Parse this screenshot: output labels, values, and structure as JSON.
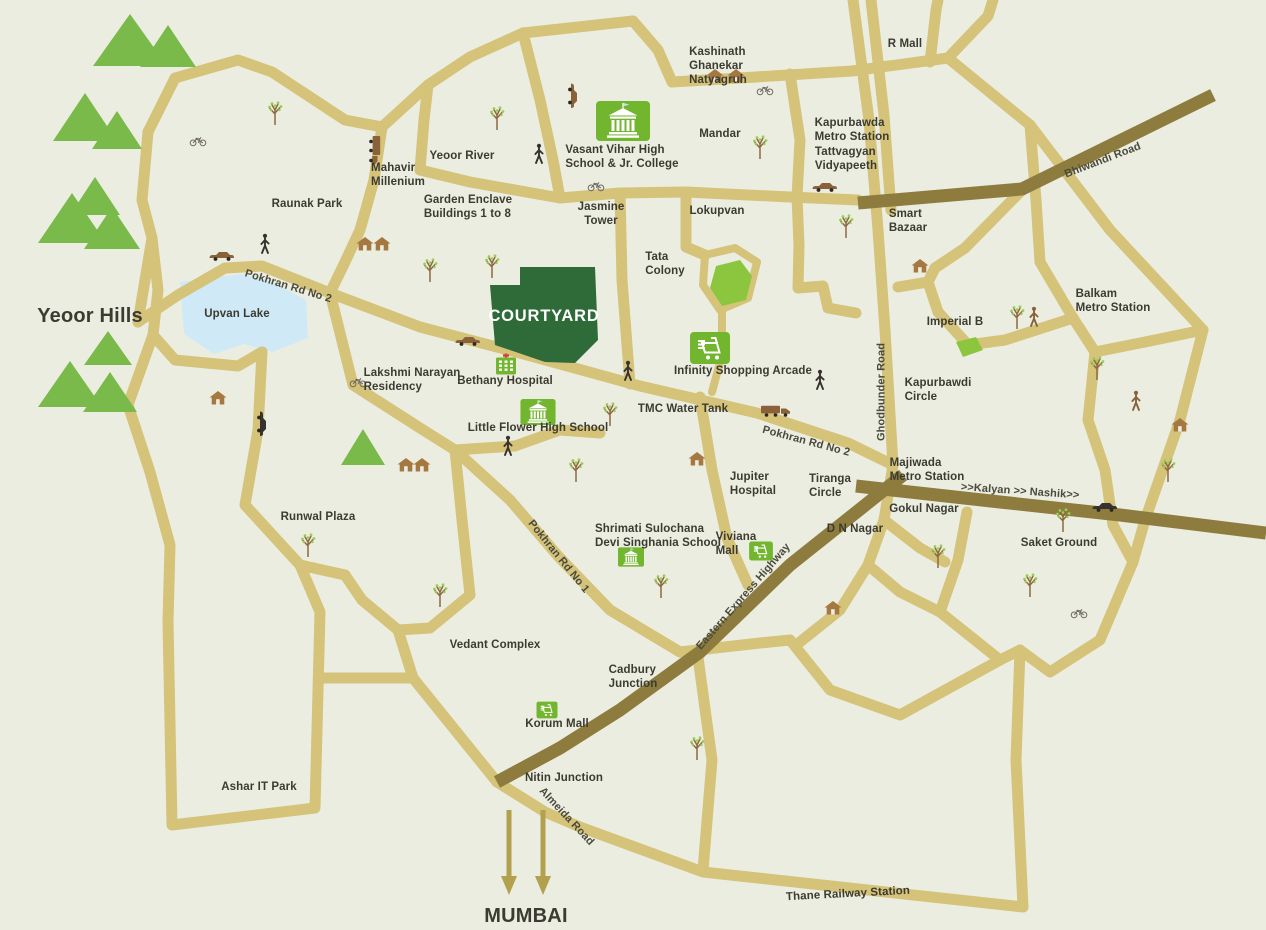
{
  "map_name": "courtyard-thane-location-map",
  "colors": {
    "background": "#ecede1",
    "road_tan": "#d5c37a",
    "highway_olive": "#8d7c3e",
    "text_ink": "#3b3b31",
    "road_label": "#4a4a3c",
    "courtyard_green": "#2e6b38",
    "hills_green": "#79ba4b",
    "colony_green": "#8cc63f",
    "landmark_icon_green": "#72b52e",
    "lake_blue": "#cfe9f6",
    "house_brown": "#a5783f",
    "cross_red": "#d84338",
    "arrow_gold": "#b2a04e"
  },
  "labels": [
    {
      "id": "yeoor-hills",
      "text": "Yeoor Hills",
      "x": 90,
      "y": 316,
      "cls": "big"
    },
    {
      "id": "mumbai",
      "text": "MUMBAI",
      "x": 526,
      "y": 916,
      "cls": "big ctr"
    },
    {
      "id": "courtyard",
      "text": "COURTYARD",
      "x": 544,
      "y": 316,
      "cls": "white ctr"
    },
    {
      "id": "kashinath-ghanekar-natyagruh",
      "text": "Kashinath\nGhanekar\nNatyagruh",
      "x": 718,
      "y": 66
    },
    {
      "id": "r-mall",
      "text": "R Mall",
      "x": 905,
      "y": 44
    },
    {
      "id": "mandar",
      "text": "Mandar",
      "x": 720,
      "y": 134
    },
    {
      "id": "kapurbawda-metro-station",
      "text": "Kapurbawda\nMetro Station",
      "x": 852,
      "y": 130
    },
    {
      "id": "tattvagyan-vidyapeeth",
      "text": "Tattvagyan\nVidyapeeth",
      "x": 846,
      "y": 159
    },
    {
      "id": "bhiwandi-road",
      "text": "Bhiwandi Road",
      "x": 1103,
      "y": 161,
      "rot": -21,
      "cls": "road-lbl"
    },
    {
      "id": "vasant-vihar-school",
      "text": "Vasant Vihar High\nSchool & Jr. College",
      "x": 622,
      "y": 157
    },
    {
      "id": "yeoor-river",
      "text": "Yeoor River",
      "x": 462,
      "y": 156
    },
    {
      "id": "mahavir-millenium",
      "text": "Mahavir\nMillenium",
      "x": 398,
      "y": 175
    },
    {
      "id": "garden-enclave",
      "text": "Garden Enclave\nBuildings 1 to 8",
      "x": 468,
      "y": 207
    },
    {
      "id": "jasmine-tower",
      "text": "Jasmine\nTower",
      "x": 601,
      "y": 214,
      "cls": "ctr"
    },
    {
      "id": "lokupvan",
      "text": "Lokupvan",
      "x": 717,
      "y": 211
    },
    {
      "id": "raunak-park",
      "text": "Raunak Park",
      "x": 307,
      "y": 204
    },
    {
      "id": "smart-bazaar",
      "text": "Smart\nBazaar",
      "x": 908,
      "y": 221
    },
    {
      "id": "tata-colony",
      "text": "Tata\nColony",
      "x": 665,
      "y": 264
    },
    {
      "id": "balkam-metro-station",
      "text": "Balkam\nMetro Station",
      "x": 1113,
      "y": 301
    },
    {
      "id": "pokhran-rd-2-west",
      "text": "Pokhran Rd No 2",
      "x": 288,
      "y": 287,
      "rot": 17,
      "cls": "road-lbl"
    },
    {
      "id": "upvan-lake",
      "text": "Upvan Lake",
      "x": 237,
      "y": 314
    },
    {
      "id": "imperial-b",
      "text": "Imperial B",
      "x": 955,
      "y": 322
    },
    {
      "id": "bethany-hospital",
      "text": "Bethany Hospital",
      "x": 505,
      "y": 381
    },
    {
      "id": "lakshmi-narayan-residency",
      "text": "Lakshmi Narayan\nResidency",
      "x": 412,
      "y": 380
    },
    {
      "id": "infinity-shopping-arcade",
      "text": "Infinity Shopping Arcade",
      "x": 743,
      "y": 371
    },
    {
      "id": "ghodbunder-road",
      "text": "Ghodbunder Road",
      "x": 882,
      "y": 392,
      "rot": -90,
      "cls": "road-lbl"
    },
    {
      "id": "kapurbawdi-circle",
      "text": "Kapurbawdi\nCircle",
      "x": 938,
      "y": 390
    },
    {
      "id": "little-flower-high-school",
      "text": "Little Flower High School",
      "x": 538,
      "y": 428
    },
    {
      "id": "tmc-water-tank",
      "text": "TMC Water Tank",
      "x": 683,
      "y": 409
    },
    {
      "id": "pokhran-rd-2-east",
      "text": "Pokhran Rd No 2",
      "x": 806,
      "y": 442,
      "rot": 15,
      "cls": "road-lbl"
    },
    {
      "id": "majiwada-metro-station",
      "text": "Majiwada\nMetro Station",
      "x": 927,
      "y": 470
    },
    {
      "id": "jupiter-hospital",
      "text": "Jupiter\nHospital",
      "x": 753,
      "y": 484
    },
    {
      "id": "tiranga-circle",
      "text": "Tiranga\nCircle",
      "x": 830,
      "y": 486
    },
    {
      "id": "d-n-nagar",
      "text": "D N Nagar",
      "x": 855,
      "y": 529
    },
    {
      "id": "kalyan-nashik",
      "text": ">>Kalyan >> Nashik>>",
      "x": 1020,
      "y": 492,
      "rot": 4,
      "cls": "road-lbl"
    },
    {
      "id": "gokul-nagar",
      "text": "Gokul Nagar",
      "x": 924,
      "y": 509
    },
    {
      "id": "saket-ground",
      "text": "Saket Ground",
      "x": 1059,
      "y": 543
    },
    {
      "id": "runwal-plaza",
      "text": "Runwal Plaza",
      "x": 318,
      "y": 517
    },
    {
      "id": "shrimati-sulochana-school",
      "text": "Shrimati Sulochana\nDevi Singhania School",
      "x": 658,
      "y": 536
    },
    {
      "id": "viviana-mall",
      "text": "Viviana\nMall",
      "x": 736,
      "y": 544
    },
    {
      "id": "eastern-express-highway",
      "text": "Eastern Express Highway",
      "x": 744,
      "y": 597,
      "rot": -49,
      "cls": "road-lbl"
    },
    {
      "id": "pokhran-rd-1",
      "text": "Pokhran Rd No 1",
      "x": 558,
      "y": 557,
      "rot": 51,
      "cls": "road-lbl"
    },
    {
      "id": "vedant-complex",
      "text": "Vedant Complex",
      "x": 495,
      "y": 645
    },
    {
      "id": "cadbury-junction",
      "text": "Cadbury\nJunction",
      "x": 633,
      "y": 677
    },
    {
      "id": "korum-mall",
      "text": "Korum Mall",
      "x": 557,
      "y": 724
    },
    {
      "id": "nitin-junction",
      "text": "Nitin Junction",
      "x": 564,
      "y": 778
    },
    {
      "id": "almeida-road",
      "text": "Almeida Road",
      "x": 566,
      "y": 817,
      "rot": 47,
      "cls": "road-lbl"
    },
    {
      "id": "ashar-it-park",
      "text": "Ashar IT Park",
      "x": 259,
      "y": 787
    },
    {
      "id": "thane-railway-station",
      "text": "Thane Railway Station",
      "x": 848,
      "y": 894,
      "rot": -3
    }
  ],
  "icons": [
    {
      "t": "hill",
      "x": 130,
      "y": 40,
      "w": 74,
      "h": 52
    },
    {
      "t": "hill",
      "x": 168,
      "y": 46,
      "w": 56,
      "h": 42
    },
    {
      "t": "hill",
      "x": 85,
      "y": 117,
      "w": 64,
      "h": 48
    },
    {
      "t": "hill",
      "x": 117,
      "y": 130,
      "w": 50,
      "h": 38
    },
    {
      "t": "hill",
      "x": 95,
      "y": 196,
      "w": 50,
      "h": 38
    },
    {
      "t": "hill",
      "x": 72,
      "y": 218,
      "w": 68,
      "h": 50
    },
    {
      "t": "hill",
      "x": 112,
      "y": 228,
      "w": 56,
      "h": 42
    },
    {
      "t": "hill",
      "x": 108,
      "y": 348,
      "w": 48,
      "h": 34
    },
    {
      "t": "hill",
      "x": 70,
      "y": 384,
      "w": 64,
      "h": 46
    },
    {
      "t": "hill",
      "x": 110,
      "y": 392,
      "w": 54,
      "h": 40
    },
    {
      "t": "hill",
      "x": 363,
      "y": 447,
      "w": 44,
      "h": 36
    },
    {
      "t": "school",
      "x": 623,
      "y": 121,
      "w": 54,
      "h": 40
    },
    {
      "t": "school",
      "x": 538,
      "y": 412,
      "w": 36,
      "h": 26
    },
    {
      "t": "school",
      "x": 631,
      "y": 557,
      "w": 26,
      "h": 20
    },
    {
      "t": "hospital",
      "x": 506,
      "y": 364,
      "w": 22,
      "h": 21
    },
    {
      "t": "cart",
      "x": 710,
      "y": 348,
      "w": 40,
      "h": 32
    },
    {
      "t": "cart",
      "x": 761,
      "y": 551,
      "w": 24,
      "h": 19
    },
    {
      "t": "cart",
      "x": 547,
      "y": 710,
      "w": 21,
      "h": 17
    },
    {
      "t": "tree",
      "x": 275,
      "y": 113
    },
    {
      "t": "tree",
      "x": 497,
      "y": 118
    },
    {
      "t": "tree",
      "x": 430,
      "y": 270
    },
    {
      "t": "tree",
      "x": 492,
      "y": 266
    },
    {
      "t": "tree",
      "x": 760,
      "y": 147
    },
    {
      "t": "tree",
      "x": 846,
      "y": 226
    },
    {
      "t": "tree",
      "x": 1017,
      "y": 317
    },
    {
      "t": "tree",
      "x": 610,
      "y": 414
    },
    {
      "t": "tree",
      "x": 576,
      "y": 470
    },
    {
      "t": "tree",
      "x": 661,
      "y": 586
    },
    {
      "t": "tree",
      "x": 697,
      "y": 748
    },
    {
      "t": "tree",
      "x": 1097,
      "y": 368
    },
    {
      "t": "tree",
      "x": 1063,
      "y": 520
    },
    {
      "t": "tree",
      "x": 1030,
      "y": 585
    },
    {
      "t": "tree",
      "x": 308,
      "y": 545
    },
    {
      "t": "tree",
      "x": 440,
      "y": 595
    },
    {
      "t": "tree",
      "x": 938,
      "y": 556
    },
    {
      "t": "tree",
      "x": 1168,
      "y": 470
    },
    {
      "t": "house",
      "x": 715,
      "y": 76
    },
    {
      "t": "house",
      "x": 736,
      "y": 76
    },
    {
      "t": "house",
      "x": 920,
      "y": 266
    },
    {
      "t": "house",
      "x": 365,
      "y": 244
    },
    {
      "t": "house",
      "x": 382,
      "y": 244
    },
    {
      "t": "house",
      "x": 406,
      "y": 465
    },
    {
      "t": "house",
      "x": 422,
      "y": 465
    },
    {
      "t": "house",
      "x": 218,
      "y": 398
    },
    {
      "t": "house",
      "x": 697,
      "y": 459
    },
    {
      "t": "house",
      "x": 1180,
      "y": 425
    },
    {
      "t": "house",
      "x": 833,
      "y": 608
    },
    {
      "t": "car",
      "x": 222,
      "y": 256,
      "c": "brown"
    },
    {
      "t": "car",
      "x": 262,
      "y": 424,
      "rot": 90,
      "c": "black"
    },
    {
      "t": "car",
      "x": 573,
      "y": 96,
      "rot": 90,
      "c": "brown"
    },
    {
      "t": "car",
      "x": 825,
      "y": 187,
      "c": "brown"
    },
    {
      "t": "car",
      "x": 1105,
      "y": 507,
      "c": "black"
    },
    {
      "t": "car",
      "x": 468,
      "y": 341,
      "c": "brown"
    },
    {
      "t": "truck",
      "x": 776,
      "y": 411
    },
    {
      "t": "truck",
      "x": 375,
      "y": 151,
      "rot": 90
    },
    {
      "t": "person",
      "x": 265,
      "y": 244,
      "c": "black"
    },
    {
      "t": "person",
      "x": 539,
      "y": 154,
      "c": "black"
    },
    {
      "t": "person",
      "x": 628,
      "y": 371,
      "c": "black"
    },
    {
      "t": "person",
      "x": 820,
      "y": 380,
      "c": "black"
    },
    {
      "t": "person",
      "x": 508,
      "y": 446,
      "c": "black"
    },
    {
      "t": "person",
      "x": 1034,
      "y": 317,
      "c": "brown"
    },
    {
      "t": "person",
      "x": 1136,
      "y": 401,
      "c": "brown"
    },
    {
      "t": "bike",
      "x": 198,
      "y": 141
    },
    {
      "t": "bike",
      "x": 596,
      "y": 186
    },
    {
      "t": "bike",
      "x": 765,
      "y": 90
    },
    {
      "t": "bike",
      "x": 358,
      "y": 382
    },
    {
      "t": "bike",
      "x": 1079,
      "y": 613
    },
    {
      "t": "arrow",
      "x": 509,
      "y": 853
    },
    {
      "t": "arrow",
      "x": 543,
      "y": 853
    }
  ]
}
